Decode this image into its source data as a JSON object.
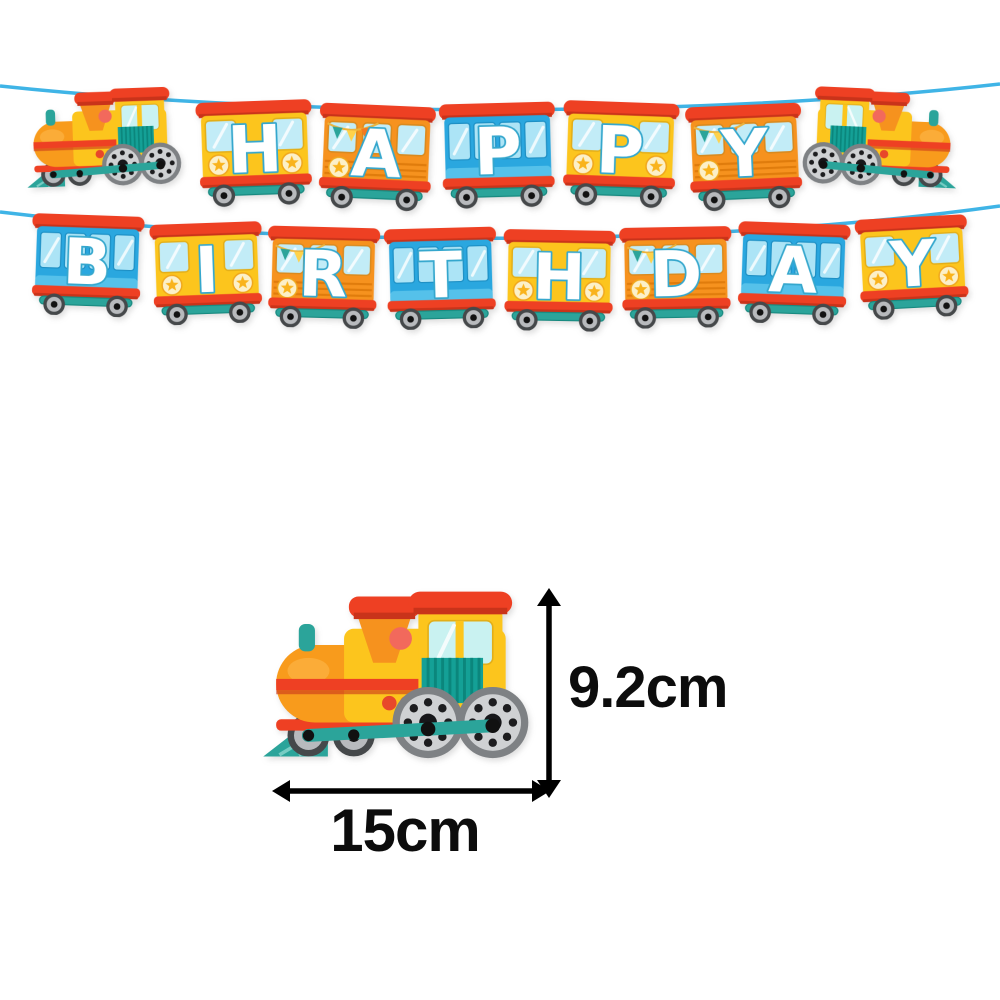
{
  "product": {
    "banner_text": "HAPPY BIRTHDAY",
    "theme": "cartoon train birthday banner"
  },
  "banner": {
    "row1": {
      "word": "HAPPY",
      "cars": [
        {
          "letter": "H",
          "color_name": "yellow"
        },
        {
          "letter": "A",
          "color_name": "orange"
        },
        {
          "letter": "P",
          "color_name": "blue"
        },
        {
          "letter": "P",
          "color_name": "yellow"
        },
        {
          "letter": "Y",
          "color_name": "orange"
        }
      ],
      "left_end": "train-engine-facing-left",
      "right_end": "train-engine-facing-right"
    },
    "row2": {
      "word": "BIRTHDAY",
      "cars": [
        {
          "letter": "B",
          "color_name": "blue"
        },
        {
          "letter": "I",
          "color_name": "yellow"
        },
        {
          "letter": "R",
          "color_name": "orange"
        },
        {
          "letter": "T",
          "color_name": "blue"
        },
        {
          "letter": "H",
          "color_name": "yellow"
        },
        {
          "letter": "D",
          "color_name": "orange"
        },
        {
          "letter": "A",
          "color_name": "blue"
        },
        {
          "letter": "Y",
          "color_name": "yellow"
        }
      ]
    }
  },
  "size_diagram": {
    "height_label": "9.2cm",
    "width_label": "15cm",
    "reference": "train-engine-illustration"
  },
  "palette": {
    "red": "#ee4023",
    "red_dark": "#c9331a",
    "orange": "#f6921e",
    "orange_boiler": "#f89b1c",
    "yellow": "#fcc51d",
    "blue": "#2aa7df",
    "blue_light_stripe": "#55c1ea",
    "window_blue": "#c2ecf7",
    "teal": "#2ba49a",
    "grille_teal": "#14a096",
    "string_blue": "#3fb4e6",
    "wheel_gray": "#b8babd",
    "letter_fill": "#ffffff",
    "letter_outline": "#35a7cd",
    "dimension_black": "#000000",
    "background": "#ffffff"
  }
}
